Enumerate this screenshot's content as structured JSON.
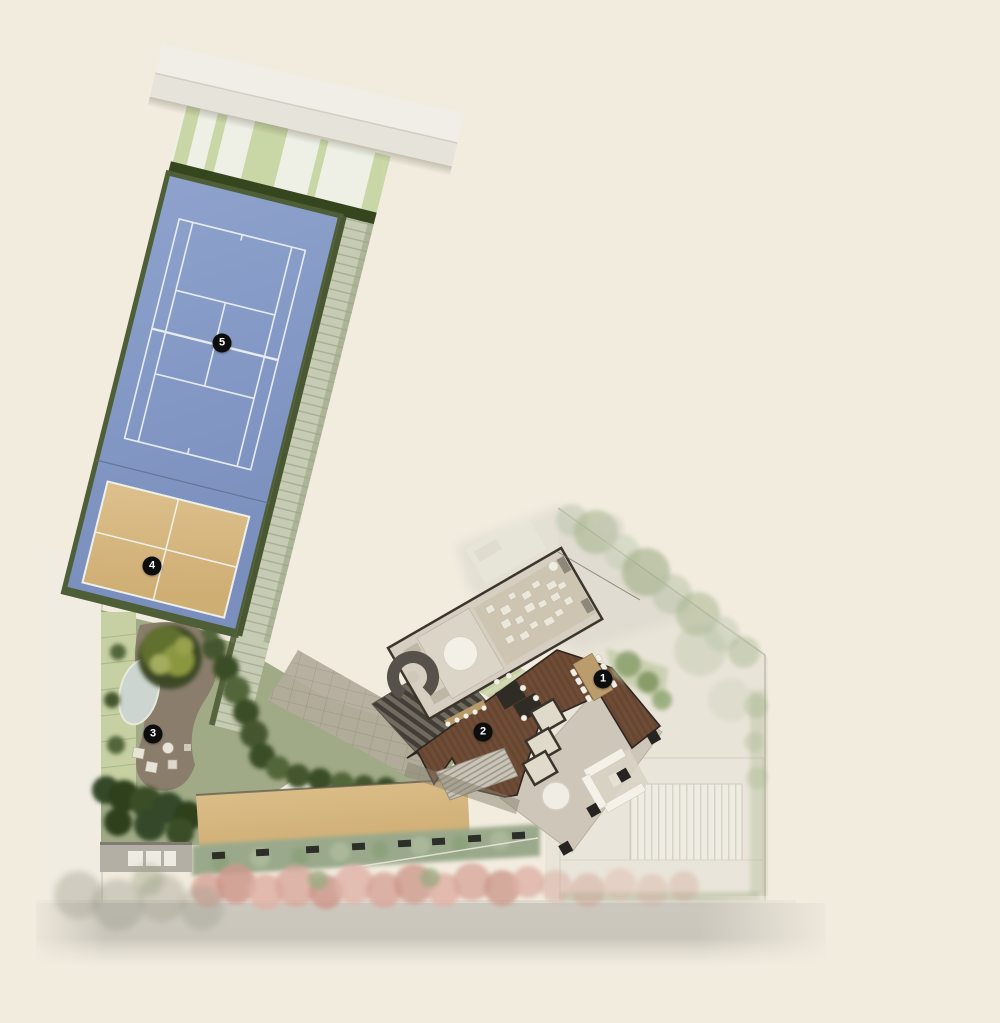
{
  "plan": {
    "title": "site-amenities-plan",
    "background_color": "#f2ecdf",
    "marker_style": {
      "background": "#0d0d0d",
      "foreground": "#ffffff",
      "diameter_px": 19
    },
    "markers": [
      {
        "number": "1",
        "x": 603,
        "y": 679
      },
      {
        "number": "2",
        "x": 483,
        "y": 732
      },
      {
        "number": "3",
        "x": 153,
        "y": 734
      },
      {
        "number": "4",
        "x": 152,
        "y": 566
      },
      {
        "number": "5",
        "x": 222,
        "y": 343
      }
    ],
    "colors": {
      "tennis_court_blue": "#8198c4",
      "court_line_white": "#edf0f5",
      "beach_court_sand": "#d6b77f",
      "hedge_dark_green": "#45552f",
      "lawn_light_green": "#c6d0a2",
      "deck_wood_brown": "#6e4c36",
      "roof_gray": "#d6cfc1",
      "path_gray": "#8a7d6c",
      "sand_strip": "#dabc86",
      "pink_trees": "#d7a79b",
      "road_gray": "#c8c4ba",
      "faded_area": "#e6e1d6"
    }
  }
}
